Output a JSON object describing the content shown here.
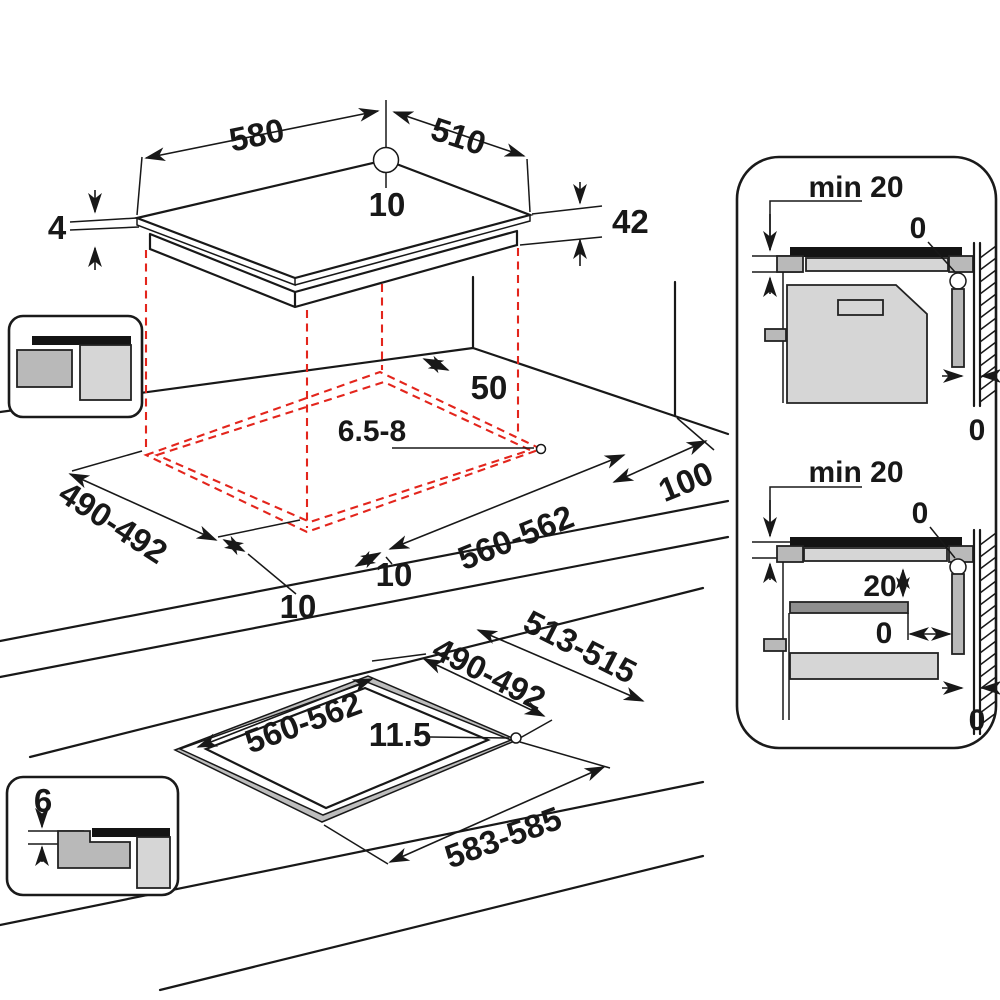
{
  "title": "Built-in hob installation dimensions diagram",
  "colors": {
    "line": "#181818",
    "cutout_dashed": "#e3251c",
    "gray_light": "#d6d6d6",
    "gray_mid": "#b9b9b9",
    "gray_dark": "#8f8f8f",
    "black_fill": "#141414"
  },
  "isometric_top": {
    "width_mm": "580",
    "depth_mm": "510",
    "rear_center_gap_mm": "10",
    "glass_thickness_mm": "4",
    "body_height_mm": "42"
  },
  "worktop_cutout": {
    "rear_clearance_mm": "50",
    "fixing_hole_mm": "6.5-8",
    "side_clearance_mm": "100",
    "cutout_width_mm": "560-562",
    "cutout_depth_mm": "490-492",
    "overhang_side_mm": "10",
    "overhang_front_mm": "10"
  },
  "flush_cutout": {
    "outer_depth_mm": "513-515",
    "inner_depth_mm": "490-492",
    "inner_width_mm": "560-562",
    "corner_radius_mm": "11.5",
    "outer_width_mm": "583-585",
    "recess_depth_mm": "6"
  },
  "side_view_top": {
    "clearance_title": "min 20",
    "seal_gap": "0",
    "wall_gap": "0"
  },
  "side_view_bottom": {
    "clearance_title": "min 20",
    "seal_gap": "0",
    "shelf_gap": "20",
    "shelf_wall_gap": "0",
    "wall_gap": "0"
  }
}
